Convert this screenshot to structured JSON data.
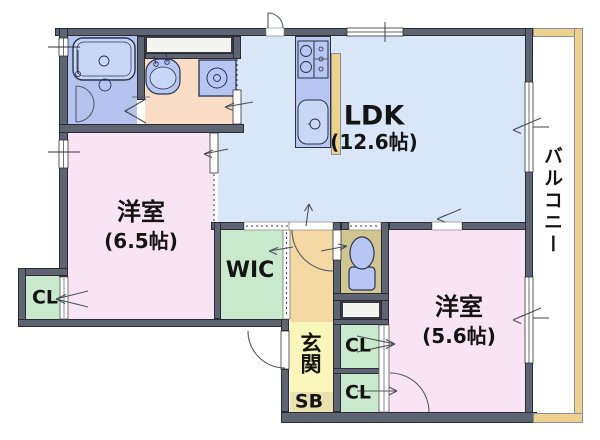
{
  "floorplan": {
    "title": "apartment-floor-plan",
    "rooms": {
      "ldk": {
        "name": "LDK",
        "size": "(12.6帖)"
      },
      "bedroom_west": {
        "name": "洋室",
        "size": "(6.5帖)"
      },
      "bedroom_south": {
        "name": "洋室",
        "size": "(5.6帖)"
      },
      "wic": {
        "name": "WIC"
      },
      "closet_west": {
        "name": "CL"
      },
      "closet_upper": {
        "name": "CL"
      },
      "closet_lower": {
        "name": "CL"
      },
      "entrance": {
        "name": "玄関"
      },
      "shoe_box": {
        "name": "SB"
      },
      "balcony": {
        "name": "バルコニー"
      }
    },
    "colors": {
      "wall": "#5f6472",
      "ldk": "#d9e6f8",
      "bedroom": "#f9e4f4",
      "closet_green": "#c9e9cd",
      "washroom_peach": "#f9dcc6",
      "bath_blue": "#b4c4ef",
      "hall_orange": "#f5d9a4",
      "entrance_yellow": "#f9f6bb",
      "shoebox_tan": "#e9e2ae",
      "toilet_olive": "#d0c692",
      "balcony_wall_tan": "#ecd28e",
      "fixture_blue": "#b7c6f2"
    }
  }
}
